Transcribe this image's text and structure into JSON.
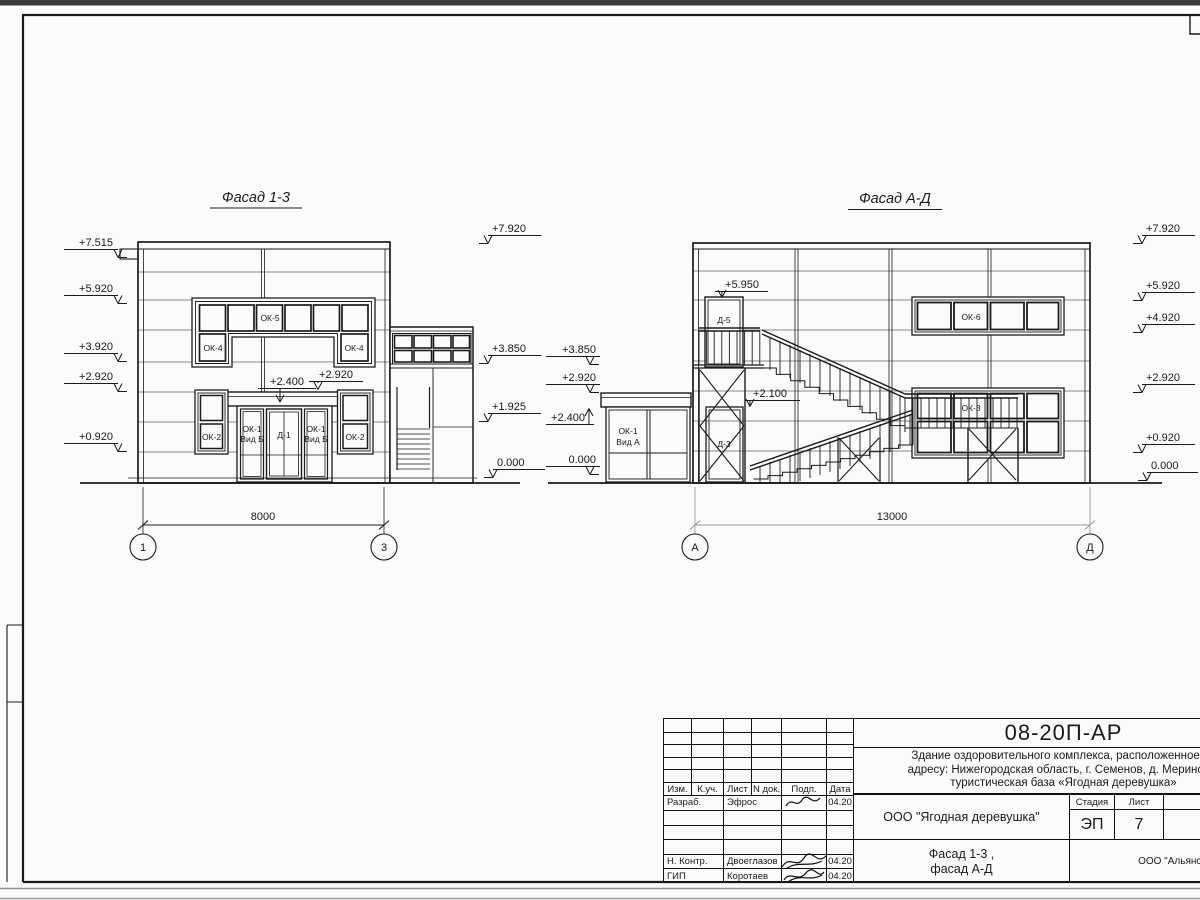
{
  "sheet": {
    "top_bar_color": "#3c3c3c",
    "line_color": "#1b1b1b",
    "gray_dim_color": "#9a9a9a"
  },
  "facade13": {
    "title": "Фасад 1-3",
    "left_marks": [
      "+7.515",
      "+5.920",
      "+3.920",
      "+2.920",
      "+0.920"
    ],
    "right_marks": [
      "+7.920",
      "+3.850",
      "+1.925",
      "0.000"
    ],
    "canopy_mark_top": "+2.400",
    "canopy_mark_side": "+2.920",
    "win_ok5": "ОК-5",
    "win_ok4_left": "ОК-4",
    "win_ok4_right": "ОК-4",
    "win_ok2_left": "ОК-2",
    "win_ok2_right": "ОК-2",
    "win_ok1_line1": "ОК-1",
    "win_ok1_line2": "Вид Б",
    "door_d1": "Д-1",
    "dim": "8000",
    "axis_left": "1",
    "axis_right": "3"
  },
  "facadeAD": {
    "title": "Фасад А-Д",
    "left_marks": [
      "+3.850",
      "+2.920",
      "+2.400",
      "0.000"
    ],
    "right_marks": [
      "+7.920",
      "+5.920",
      "+4.920",
      "+2.920",
      "+0.920",
      "0.000"
    ],
    "mark_d5": "+5.950",
    "mark_d3": "+2.100",
    "door_d5": "Д-5",
    "door_d3": "Д-3",
    "win_ok6": "ОК-6",
    "win_ok3": "ОК-3",
    "win_ok1_line1": "ОК-1",
    "win_ok1_line2": "Вид А",
    "dim": "13000",
    "axis_left": "А",
    "axis_right": "Д"
  },
  "titleblock": {
    "doc_number": "08-20П-АР",
    "description_line1": "Здание оздоровительного комплекса, расположенное по",
    "description_line2": "адресу: Нижегородская область, г. Семенов, д. Мериново,",
    "description_line3": "туристическая база «Ягодная деревушка»",
    "header": {
      "izm": "Изм.",
      "kuch": "К.уч.",
      "list": "Лист",
      "ndok": "N док.",
      "podp": "Подп.",
      "data": "Дата"
    },
    "rows": [
      {
        "role": "Разраб.",
        "name": "Эфрос",
        "date": "04.20"
      },
      {
        "role": "",
        "name": "",
        "date": ""
      },
      {
        "role": "",
        "name": "",
        "date": ""
      },
      {
        "role": "",
        "name": "",
        "date": ""
      },
      {
        "role": "Н. Контр.",
        "name": "Двоеглазов",
        "date": "04.20"
      },
      {
        "role": "ГИП",
        "name": "Коротаев",
        "date": "04.20"
      }
    ],
    "org": "ООО \"Ягодная деревушка\"",
    "stage_label": "Стадия",
    "sheet_label": "Лист",
    "sheets_label": "Листов",
    "stage": "ЭП",
    "sheet_number": "7",
    "subtitle_line1": "Фасад 1-3 ,",
    "subtitle_line2": "фасад А-Д",
    "company": "ООО \"Альянс\""
  }
}
